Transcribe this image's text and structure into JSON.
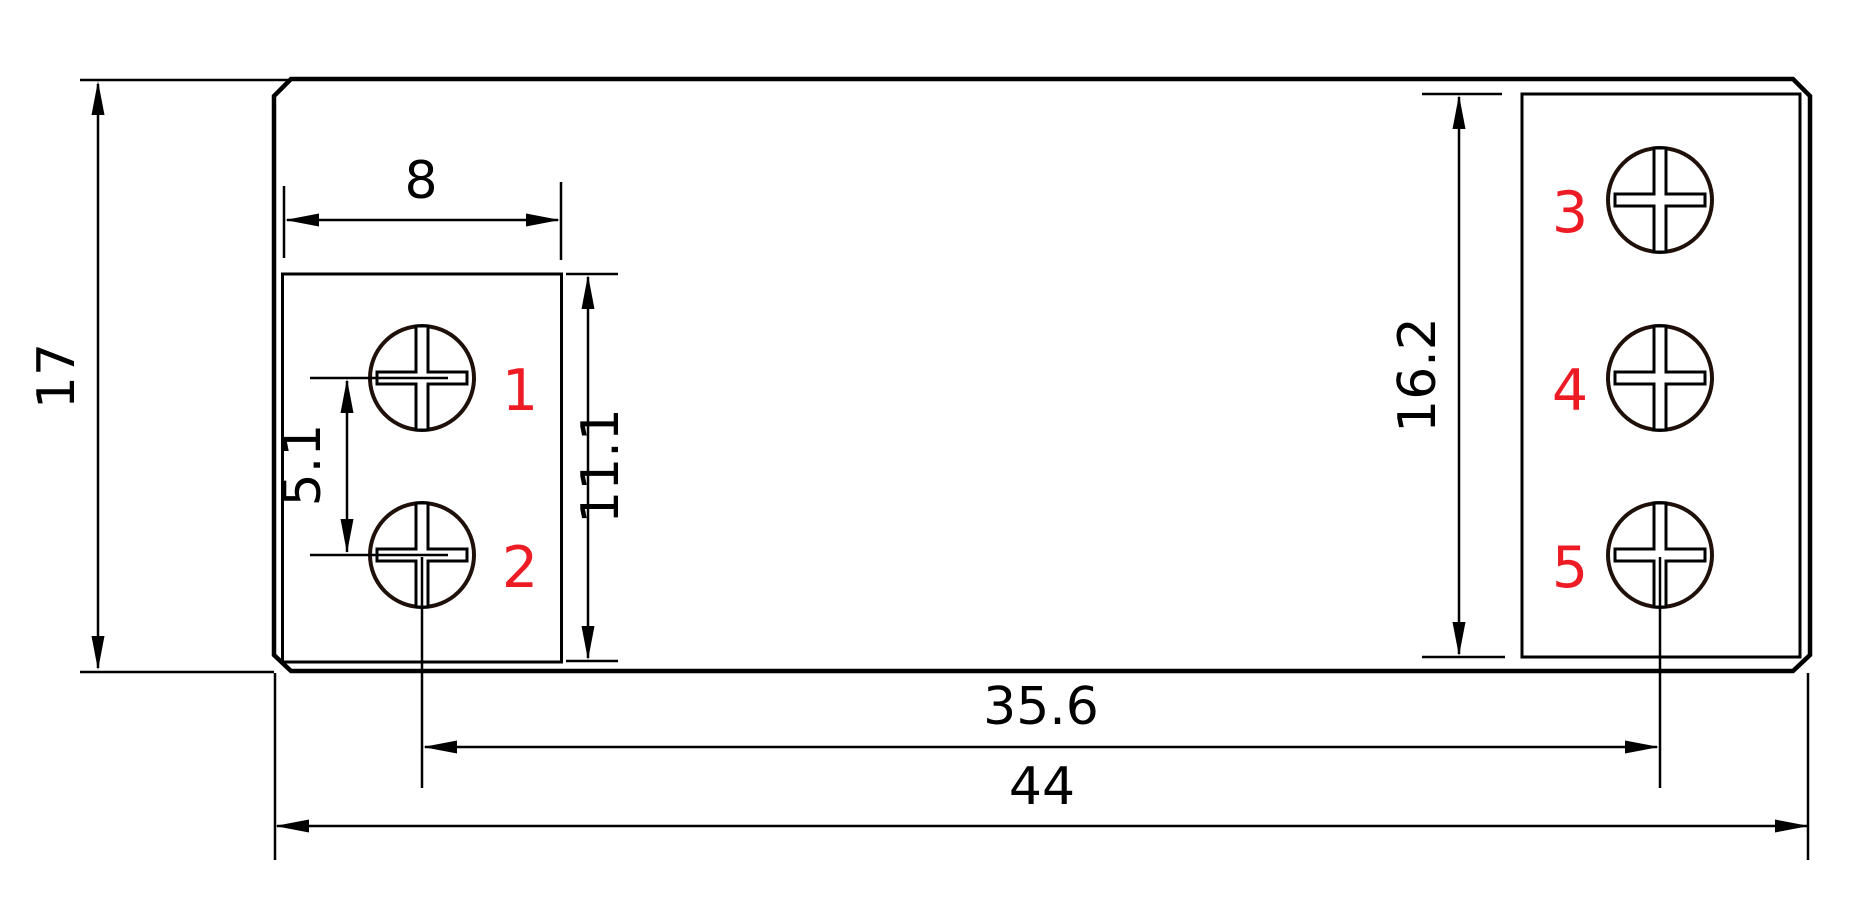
{
  "drawing": {
    "colors": {
      "line": "#000000",
      "screw_outline": "#20100a",
      "terminal_label": "#ed1c24",
      "background": "#ffffff"
    },
    "dimensions": {
      "overall_height": "17",
      "left_block_width": "8",
      "left_screw_pitch": "5.1",
      "left_block_height": "11.1",
      "right_block_height": "16.2",
      "screw_center_span": "35.6",
      "overall_width": "44"
    },
    "terminals": {
      "t1": "1",
      "t2": "2",
      "t3": "3",
      "t4": "4",
      "t5": "5"
    }
  }
}
